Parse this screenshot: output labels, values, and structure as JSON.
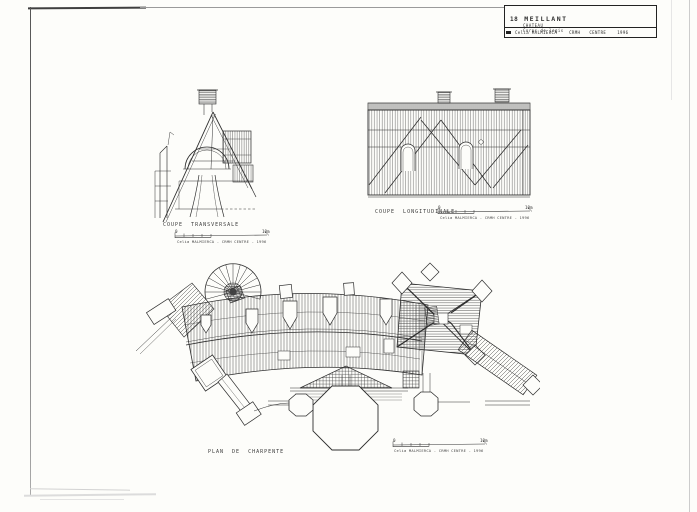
{
  "sheet": {
    "title_block": {
      "number": "18",
      "name": "MEILLANT",
      "building": "CHATEAU",
      "part": "Corps de logis",
      "author": "Celia MALMIERCA",
      "org": "CRMH",
      "region": "CENTRE",
      "year": "1996"
    },
    "drawings": {
      "transversale": {
        "label": "COUPE TRANSVERSALE"
      },
      "longitudinale": {
        "label": "COUPE LONGITUDINALE"
      },
      "plan": {
        "label": "PLAN DE CHARPENTE"
      }
    },
    "scalebar": {
      "zero": "0",
      "max": "10m",
      "credit": "Celia MALMIERCA - CRMH CENTRE - 1996"
    }
  },
  "colors": {
    "ink": "#2e2e2e",
    "paper": "#fdfdfa",
    "frame": "#555555"
  }
}
